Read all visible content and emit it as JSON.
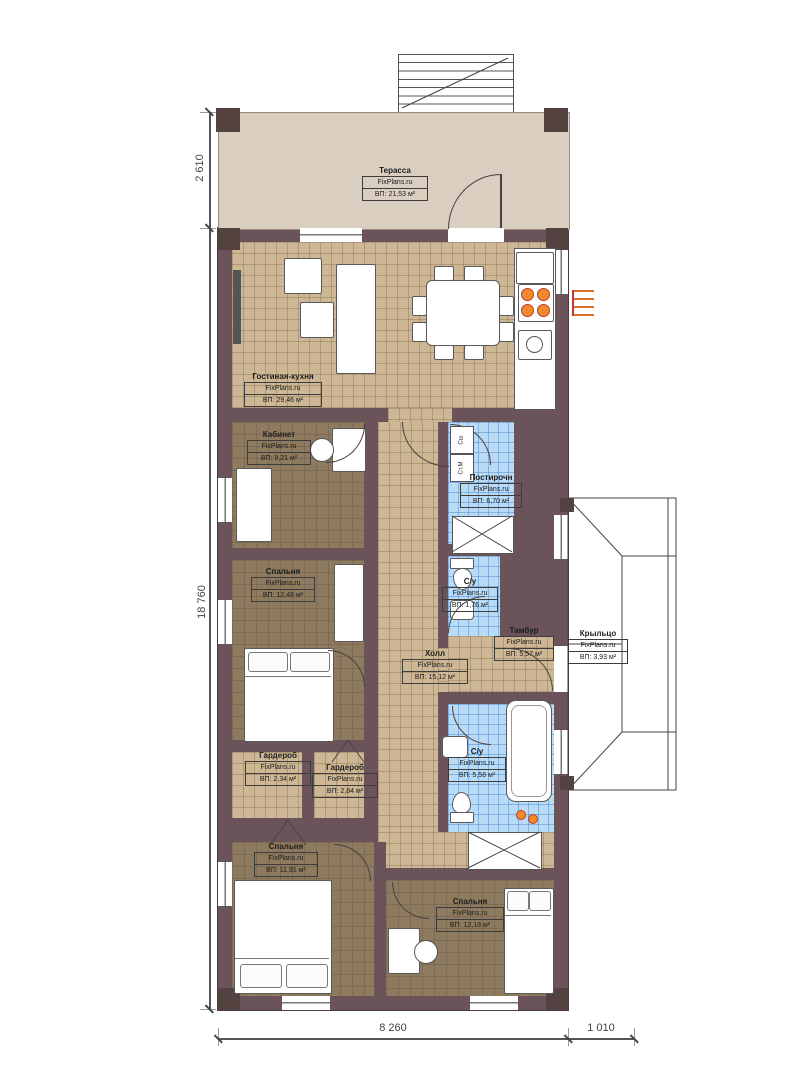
{
  "brand": "FixPlans.ru",
  "rooms": [
    {
      "id": "terrace",
      "name": "Терасса",
      "watermark": "FixPlans.ru",
      "area": "ВП: 21,53 м²"
    },
    {
      "id": "living-kitchen",
      "name": "Гостиная-кухня",
      "watermark": "FixPlans.ru",
      "area": "ВП: 29,46 м²"
    },
    {
      "id": "office",
      "name": "Кабинет",
      "watermark": "FixPlans.ru",
      "area": "ВП: 9,21 м²"
    },
    {
      "id": "laundry",
      "name": "Постирочн",
      "watermark": "FixPlans.ru",
      "area": "ВП: 6,70 м²"
    },
    {
      "id": "bedroom-1",
      "name": "Спальня",
      "watermark": "FixPlans.ru",
      "area": "ВП: 12,48 м²"
    },
    {
      "id": "bathroom-upper",
      "name": "С/у",
      "watermark": "FixPlans.ru",
      "area": "ВП: 1,76 м²"
    },
    {
      "id": "vestibule",
      "name": "Тамбур",
      "watermark": "FixPlans.ru",
      "area": "ВП: 5,57 м²"
    },
    {
      "id": "porch",
      "name": "Крыльцо",
      "watermark": "FixPlans.ru",
      "area": "ВП: 3,93 м²"
    },
    {
      "id": "hall",
      "name": "Холл",
      "watermark": "FixPlans.ru",
      "area": "ВП: 15,12 м²"
    },
    {
      "id": "wardrobe-1",
      "name": "Гардероб",
      "watermark": "FixPlans.ru",
      "area": "ВП: 2,34 м²"
    },
    {
      "id": "wardrobe-2",
      "name": "Гардероб",
      "watermark": "FixPlans.ru",
      "area": "ВП: 2,84 м²"
    },
    {
      "id": "bathroom-lower",
      "name": "С/у",
      "watermark": "FixPlans.ru",
      "area": "ВП: 5,58 м²"
    },
    {
      "id": "bedroom-2",
      "name": "Спальня",
      "watermark": "FixPlans.ru",
      "area": "ВП: 11,91 м²"
    },
    {
      "id": "bedroom-3",
      "name": "Спальня",
      "watermark": "FixPlans.ru",
      "area": "ВП: 12,18 м²"
    }
  ],
  "appliances": {
    "dryer_label": "Сш",
    "washer_label": "Ст.М"
  },
  "dimensions": {
    "terrace_depth": "2 610",
    "house_length": "18 760",
    "house_width": "8 260",
    "porch_width": "1 010"
  },
  "colors": {
    "wall": "#6a545a",
    "terrace": "#d9cec0",
    "tan_floor": "#cdb794",
    "brown_floor": "#8d7a5f",
    "tile_blue": "#badbf5",
    "burner_orange": "#f08b2d"
  }
}
